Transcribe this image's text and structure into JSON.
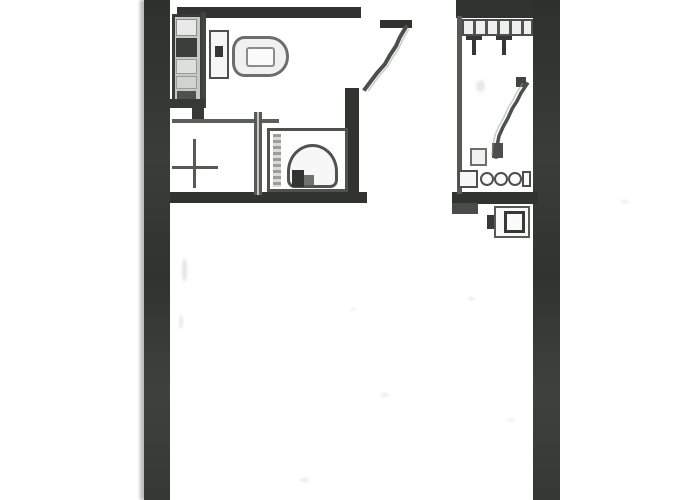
{
  "document": {
    "kind_label": "floor-plan-scan",
    "visible_text": ""
  },
  "colors": {
    "page_bg": "#ffffff",
    "wall_dark": "#2e312e",
    "wall_mid": "#474b47",
    "line_dark": "#4a4d4a",
    "line_mid": "#6a6d6a",
    "line_light": "#9a9d99",
    "fill_white": "#fafafa",
    "fill_light": "#ececec",
    "cell_dark": "#393c39"
  },
  "plan": {
    "rooms": [
      {
        "name": "bathroom",
        "position": "top-left"
      },
      {
        "name": "kitchenette",
        "position": "left-middle"
      },
      {
        "name": "main-room",
        "position": "center-bottom"
      },
      {
        "name": "closet-room",
        "position": "top-right"
      }
    ],
    "fixtures": [
      "cabinet-stack",
      "toilet-tank",
      "toilet-bowl",
      "sink-basin",
      "cross-mark",
      "entry-door-swing",
      "shelf-row",
      "hanger-hooks",
      "ladder-line",
      "drawer-row",
      "wall-mounted-box"
    ]
  }
}
